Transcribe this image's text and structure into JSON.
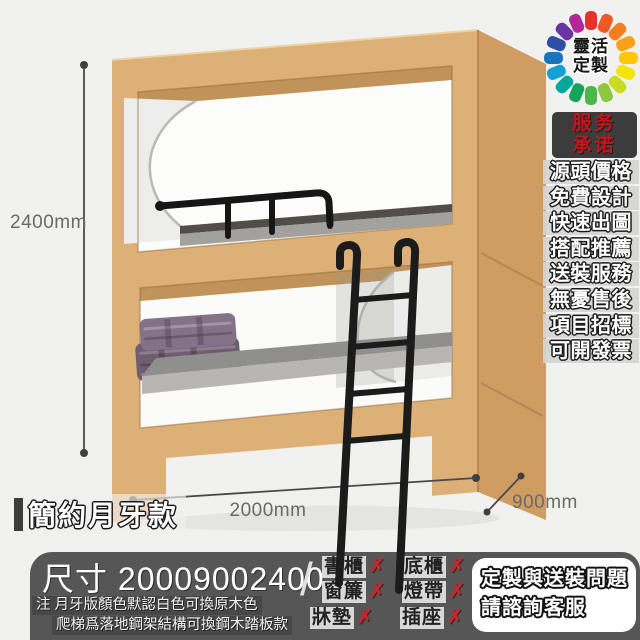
{
  "logo": {
    "line1": "靈活",
    "line2": "定製"
  },
  "service": {
    "badge_line1": "服务",
    "badge_line2": "承诺",
    "items": [
      "源頭價格",
      "免費設計",
      "快速出圖",
      "搭配推薦",
      "送裝服務",
      "無憂售後",
      "項目招標",
      "可開發票"
    ]
  },
  "dimensions": {
    "height": "2400mm",
    "length": "2000mm",
    "depth": "900mm"
  },
  "style_label": "簡約月牙款",
  "bottom_bar": {
    "size_label": "尺寸 20009002400",
    "note1": "注 月牙版顏色默認白色可換原木色",
    "note2": "爬梯爲落地鋼架結構可換鋼木踏板款",
    "divider": "/",
    "options": [
      {
        "label": "書櫃",
        "mark": "✗"
      },
      {
        "label": "底櫃",
        "mark": "✗"
      },
      {
        "label": "窗簾",
        "mark": "✗"
      },
      {
        "label": "燈帶",
        "mark": "✗"
      },
      {
        "label": "牀墊",
        "mark": "✗"
      },
      {
        "label": "插座",
        "mark": "✗"
      }
    ],
    "cta_line1": "定製與送裝問題",
    "cta_line2": "請諮詢客服"
  },
  "colors": {
    "wood_front": "#ddb078",
    "wood_side": "#cf9d62",
    "accent_red": "#c4161c",
    "bar_bg": "#565656",
    "wheel": [
      "#e3342b",
      "#ef5923",
      "#f57e20",
      "#f9a11b",
      "#fbc707",
      "#f3e50a",
      "#c8dc21",
      "#8fc73e",
      "#4bb748",
      "#12a55b",
      "#00a79d",
      "#12a0d6",
      "#1b75bb",
      "#2e4fa3",
      "#6a35a0",
      "#b0289b"
    ]
  }
}
